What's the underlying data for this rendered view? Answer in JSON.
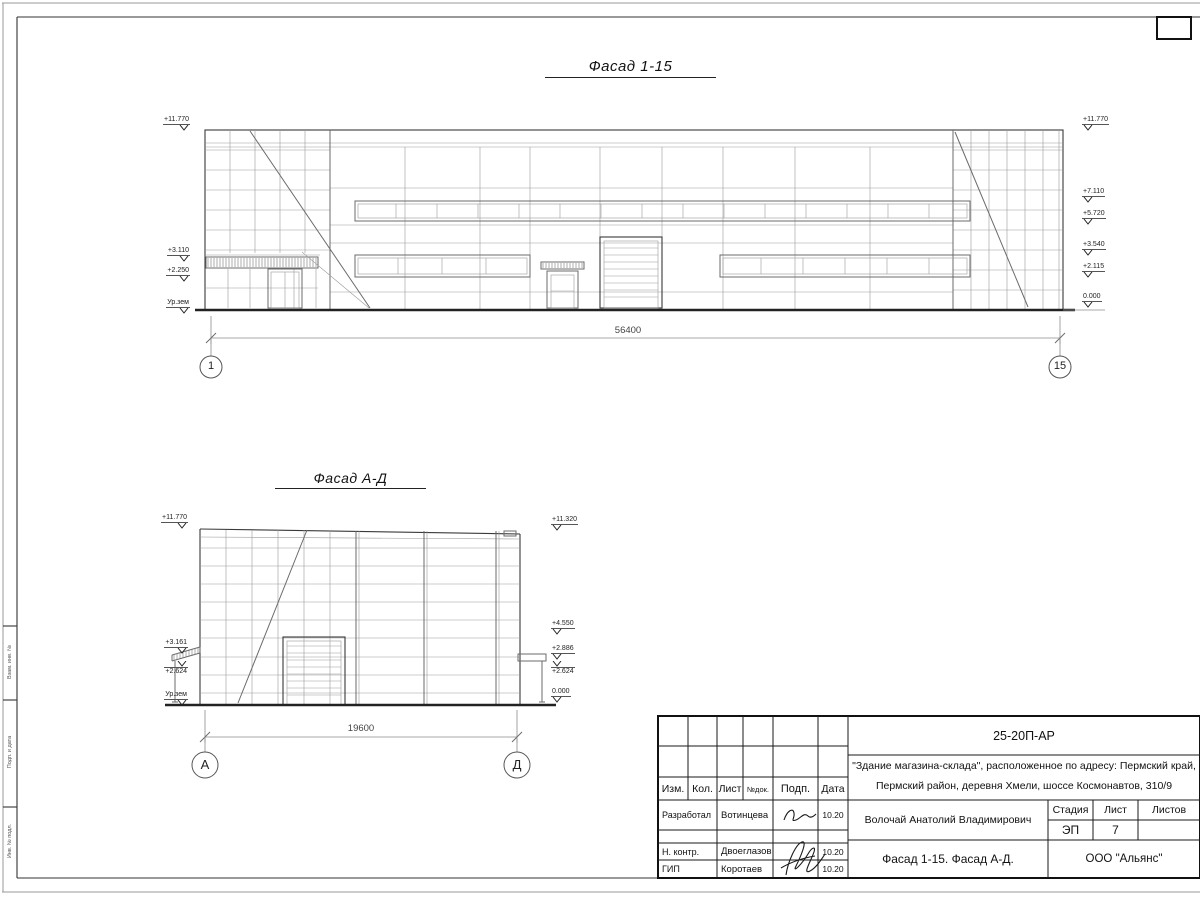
{
  "facade1": {
    "title": "Фасад 1-15",
    "dimension": "56400",
    "axis_left": "1",
    "axis_right": "15",
    "marks_left": [
      "+11.770",
      "+3.110",
      "+2.250",
      "Ур.зем"
    ],
    "marks_right": [
      "+11.770",
      "+7.110",
      "+5.720",
      "+3.540",
      "+2.115",
      "0.000"
    ]
  },
  "facade2": {
    "title": "Фасад А-Д",
    "dimension": "19600",
    "axis_left": "А",
    "axis_right": "Д",
    "marks_left": [
      "+11.770",
      "+3.161",
      "+2.624",
      "Ур.зем"
    ],
    "marks_right": [
      "+11.320",
      "+4.550",
      "+2.886",
      "+2.624",
      "0.000"
    ]
  },
  "titleblock": {
    "doc_code": "25-20П-АР",
    "project_line1": "\"Здание магазина-склада\", расположенное по адресу: Пермский край,",
    "project_line2": "Пермский район, деревня Хмели, шоссе Космонавтов, 310/9",
    "headers": {
      "izm": "Изм.",
      "kol": "Кол.",
      "list": "Лист",
      "ndok": "№док.",
      "podp": "Подп.",
      "data": "Дата"
    },
    "rows": [
      {
        "role": "Разработал",
        "name": "Вотинцева",
        "date": "10.20"
      },
      {
        "role": "Н. контр.",
        "name": "Двоеглазов",
        "date": "10.20"
      },
      {
        "role": "ГИП",
        "name": "Коротаев",
        "date": "10.20"
      }
    ],
    "approver": "Волочай Анатолий Владимирович",
    "stage_label": "Стадия",
    "sheet_label": "Лист",
    "sheets_label": "Листов",
    "stage": "ЭП",
    "sheet_no": "7",
    "drawing_title": "Фасад 1-15. Фасад А-Д.",
    "company": "ООО \"Альянс\""
  },
  "side_stamp": {
    "labels": [
      "Взам. инв. №",
      "Подп. и дата",
      "Инв. № подл."
    ]
  }
}
